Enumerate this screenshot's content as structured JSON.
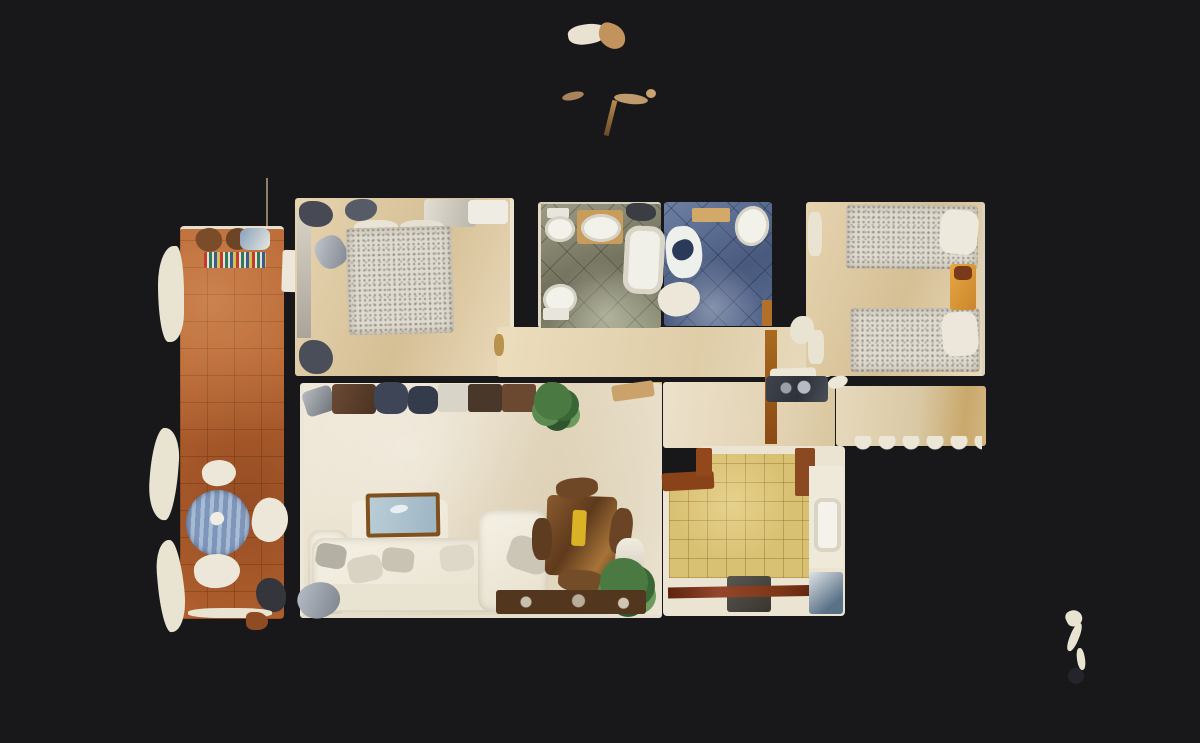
{
  "scene": {
    "type": "3d-scan-floorplan-top-down",
    "description": "Top-down dollhouse view of a 3D-scanned apartment floor plan on a dark background",
    "background_color": "#18181b"
  },
  "palette": {
    "background": "#18181b",
    "terrace_tile": "#b5622f",
    "bedroom_floor": "#ddc9a2",
    "living_room_floor": "#ece4d2",
    "kitchen_tile": "#d9c173",
    "bathroom_gray_tile": "#8b8b74",
    "bathroom_blue_tile": "#56688e",
    "wall_light": "#eae3d2",
    "dark_wood_plank": "#7a3416",
    "bed_duvet_speckle": "#dedacf",
    "sofa_white": "#f2eee2",
    "plant_green": "#4a7a42",
    "terrace_table_blue": "#8aa0c2",
    "nightstand_orange": "#dd9a3c",
    "rug_stripes": [
      "#c23b2e",
      "#2e7a5a",
      "#3a5a9a",
      "#d8c050"
    ]
  },
  "rooms": [
    {
      "id": "terrace",
      "name": "Terrace"
    },
    {
      "id": "master-bedroom",
      "name": "Master bedroom"
    },
    {
      "id": "bathroom-gray",
      "name": "Bathroom (gray tile)"
    },
    {
      "id": "bathroom-blue",
      "name": "Bathroom (blue tile)"
    },
    {
      "id": "twin-bedroom",
      "name": "Twin bedroom"
    },
    {
      "id": "hallway",
      "name": "Hallway"
    },
    {
      "id": "entry-corridor",
      "name": "Entry corridor"
    },
    {
      "id": "right-corridor",
      "name": "Right corridor"
    },
    {
      "id": "living-room",
      "name": "Living room"
    },
    {
      "id": "kitchen",
      "name": "Kitchen"
    }
  ],
  "furniture": {
    "double_bed": "Double bed",
    "single_bed_top": "Single bed",
    "single_bed_bottom": "Single bed",
    "nightstand": "Nightstand",
    "sofa": "Corner sofa",
    "armchair": "Armchair / chaise",
    "coffee_table": "Coffee table",
    "dining_table": "Dining table",
    "console": "Console sideboard",
    "floor_lamp": "Floor lamp",
    "plant": "Potted plant",
    "terrace_table": "Striped terrace table",
    "terrace_chair": "Terrace chair",
    "striped_rug": "Striped rug",
    "bathtub": "Bathtub",
    "toilet": "Toilet",
    "washbasin": "Washbasin",
    "kitchen_sink": "Kitchen sink",
    "kitchen_counter": "Kitchen counter",
    "appliance": "Kitchen appliance",
    "laundry_unit": "Laundry / utility unit",
    "wood_plank": "Wooden threshold plank"
  },
  "artifacts": {
    "top_noise": "scan-noise fragments above floor plan",
    "bottom_right_noise": "scan-noise squiggle bottom right",
    "left_edge_noise": "ragged white mesh fragments on terrace left edge"
  }
}
